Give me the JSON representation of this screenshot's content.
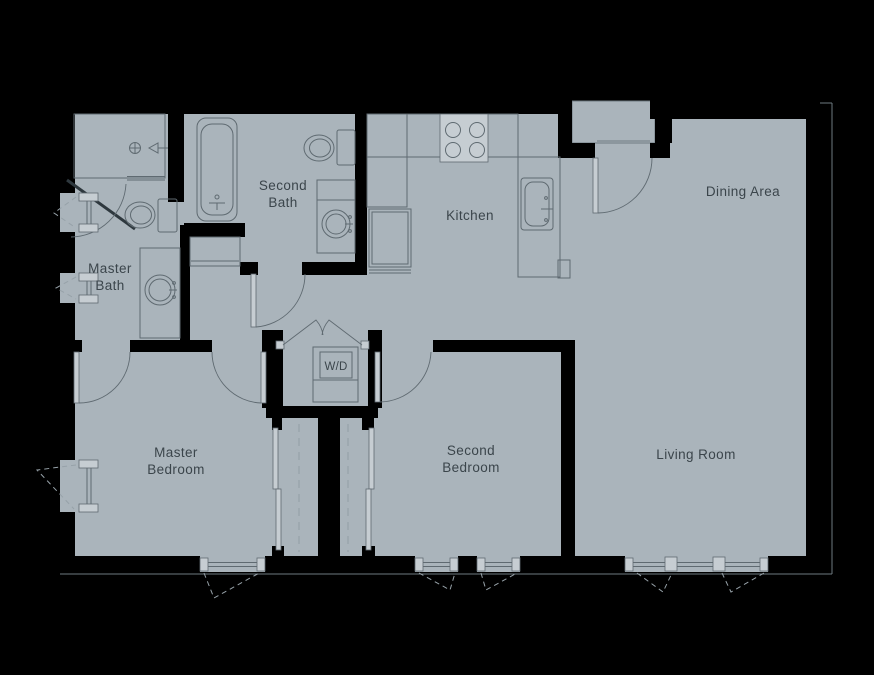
{
  "colors": {
    "background": "#000000",
    "floor": "#aab4bb",
    "wall": "#000000",
    "line": "#5f6a71",
    "line-dark": "#2e383e",
    "leaf": "#c6cdd2",
    "dash": "#97a2a9",
    "text": "#3b454b",
    "outline": "#6e7a81"
  },
  "rooms": {
    "master_bath": {
      "line1": "Master",
      "line2": "Bath"
    },
    "second_bath": {
      "line1": "Second",
      "line2": "Bath"
    },
    "kitchen": {
      "label": "Kitchen"
    },
    "dining_area": {
      "label": "Dining Area"
    },
    "master_bedroom": {
      "line1": "Master",
      "line2": "Bedroom"
    },
    "second_bedroom": {
      "line1": "Second",
      "line2": "Bedroom"
    },
    "living_room": {
      "label": "Living Room"
    },
    "laundry_closet": {
      "label": "W/D"
    }
  },
  "fixtures": {
    "master_bath": [
      "shower",
      "toilet",
      "vanity-sink",
      "linen-cabinet"
    ],
    "second_bath": [
      "bathtub",
      "toilet",
      "vanity-sink"
    ],
    "kitchen": [
      "range-4-burner",
      "refrigerator",
      "kitchen-sink",
      "counter"
    ],
    "laundry_closet": [
      "washer-dryer-stack"
    ]
  },
  "openings": {
    "doors": [
      "entry-door",
      "shower-door",
      "second-bath-door",
      "master-bedroom-bath-door",
      "master-bedroom-hall-door",
      "second-bedroom-door",
      "laundry-bifold-doors",
      "master-closet-sliding-door",
      "second-closet-sliding-door"
    ],
    "windows": [
      "left-wall-window-1",
      "left-wall-window-2",
      "left-wall-window-3",
      "master-bedroom-south-window",
      "second-bedroom-south-window-1",
      "second-bedroom-south-window-2",
      "living-room-south-window"
    ]
  }
}
